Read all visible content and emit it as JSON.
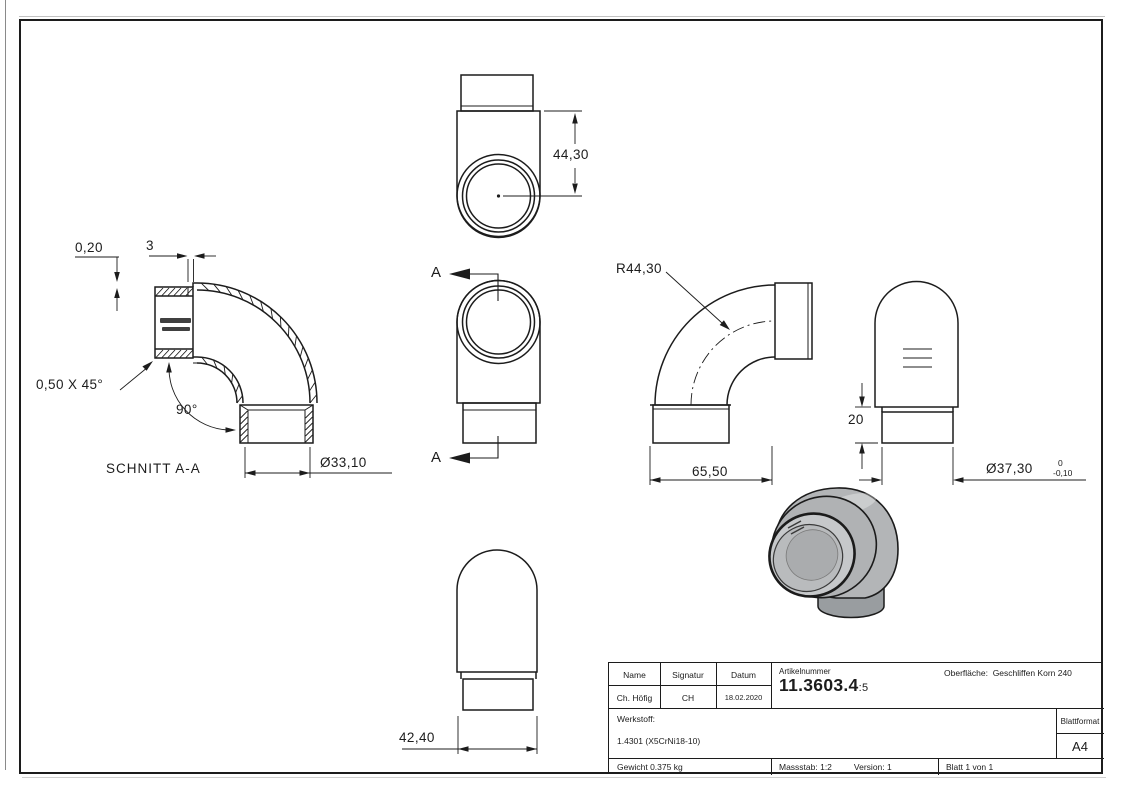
{
  "sheet": {
    "background": "#ffffff",
    "line_color": "#1c1c1c",
    "model_gray": "#b3b5b7",
    "model_gray_dark": "#999da0"
  },
  "views": {
    "section": {
      "title": "SCHNITT A-A",
      "dim_step": "0,20",
      "dim_wall": "3",
      "chamfer": "0,50 X 45°",
      "angle": "90°",
      "dia_inner": "Ø33,10"
    },
    "top": {
      "dim_height": "44,30"
    },
    "bottom_view": {
      "section_label": "A"
    },
    "front": {
      "radius": "R44,30",
      "dim_width": "65,50"
    },
    "side": {
      "dim_socket": "20",
      "dia_outer": "Ø37,30",
      "tol_upper": "0",
      "tol_lower": "-0,10"
    },
    "bottom_side": {
      "dim_width": "42,40"
    }
  },
  "title_block": {
    "headers": {
      "name": "Name",
      "signatur": "Signatur",
      "datum": "Datum",
      "artikelnummer": "Artikelnummer",
      "oberflaeche_label": "Oberfläche:",
      "werkstoff_label": "Werkstoff:",
      "blattformat_label": "Blattformat"
    },
    "values": {
      "name": "Ch. Höfig",
      "signatur": "CH",
      "datum": "18.02.2020",
      "artikelnummer": "11.3603.4",
      "artikelnummer_suffix": ":5",
      "oberflaeche": "Geschliffen Korn 240",
      "werkstoff": "1.4301 (X5CrNi18-10)",
      "blattformat": "A4",
      "gewicht": "Gewicht 0.375 kg",
      "massstab": "Massstab: 1:2",
      "version": "Version: 1",
      "blatt": "Blatt 1 von 1"
    }
  }
}
